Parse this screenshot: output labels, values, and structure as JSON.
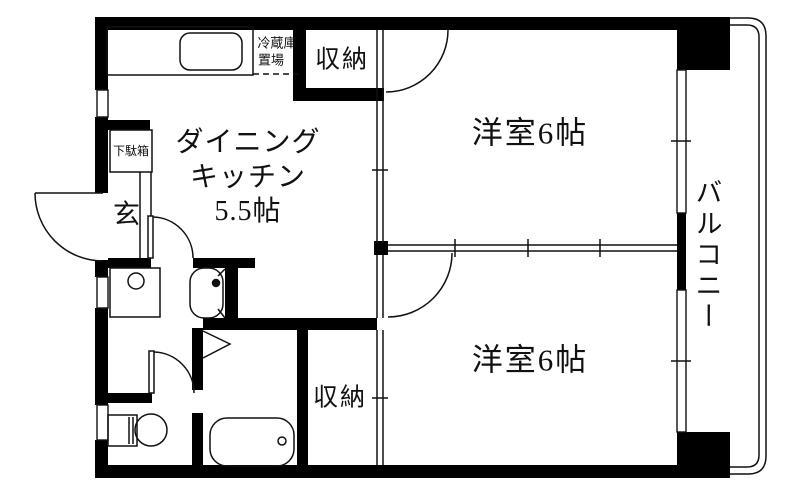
{
  "floorplan": {
    "type": "apartment-floor-plan-2DK",
    "colors": {
      "wall": "#000000",
      "background": "#ffffff",
      "line": "#111111"
    },
    "rooms": {
      "dining_kitchen": {
        "name_line1": "ダイニング",
        "name_line2": "キッチン",
        "size": "5.5帖"
      },
      "western_room_upper": {
        "name": "洋室6帖"
      },
      "western_room_lower": {
        "name": "洋室6帖"
      },
      "balcony": {
        "name": "バルコニー"
      },
      "entrance": {
        "name": "玄"
      },
      "closet_upper": {
        "name": "収納"
      },
      "closet_lower": {
        "name": "収納"
      }
    },
    "fixtures": {
      "refrigerator_space": {
        "name_line1": "冷蔵庫",
        "name_line2": "置場"
      },
      "shoe_cabinet": {
        "name": "下駄箱"
      }
    }
  }
}
